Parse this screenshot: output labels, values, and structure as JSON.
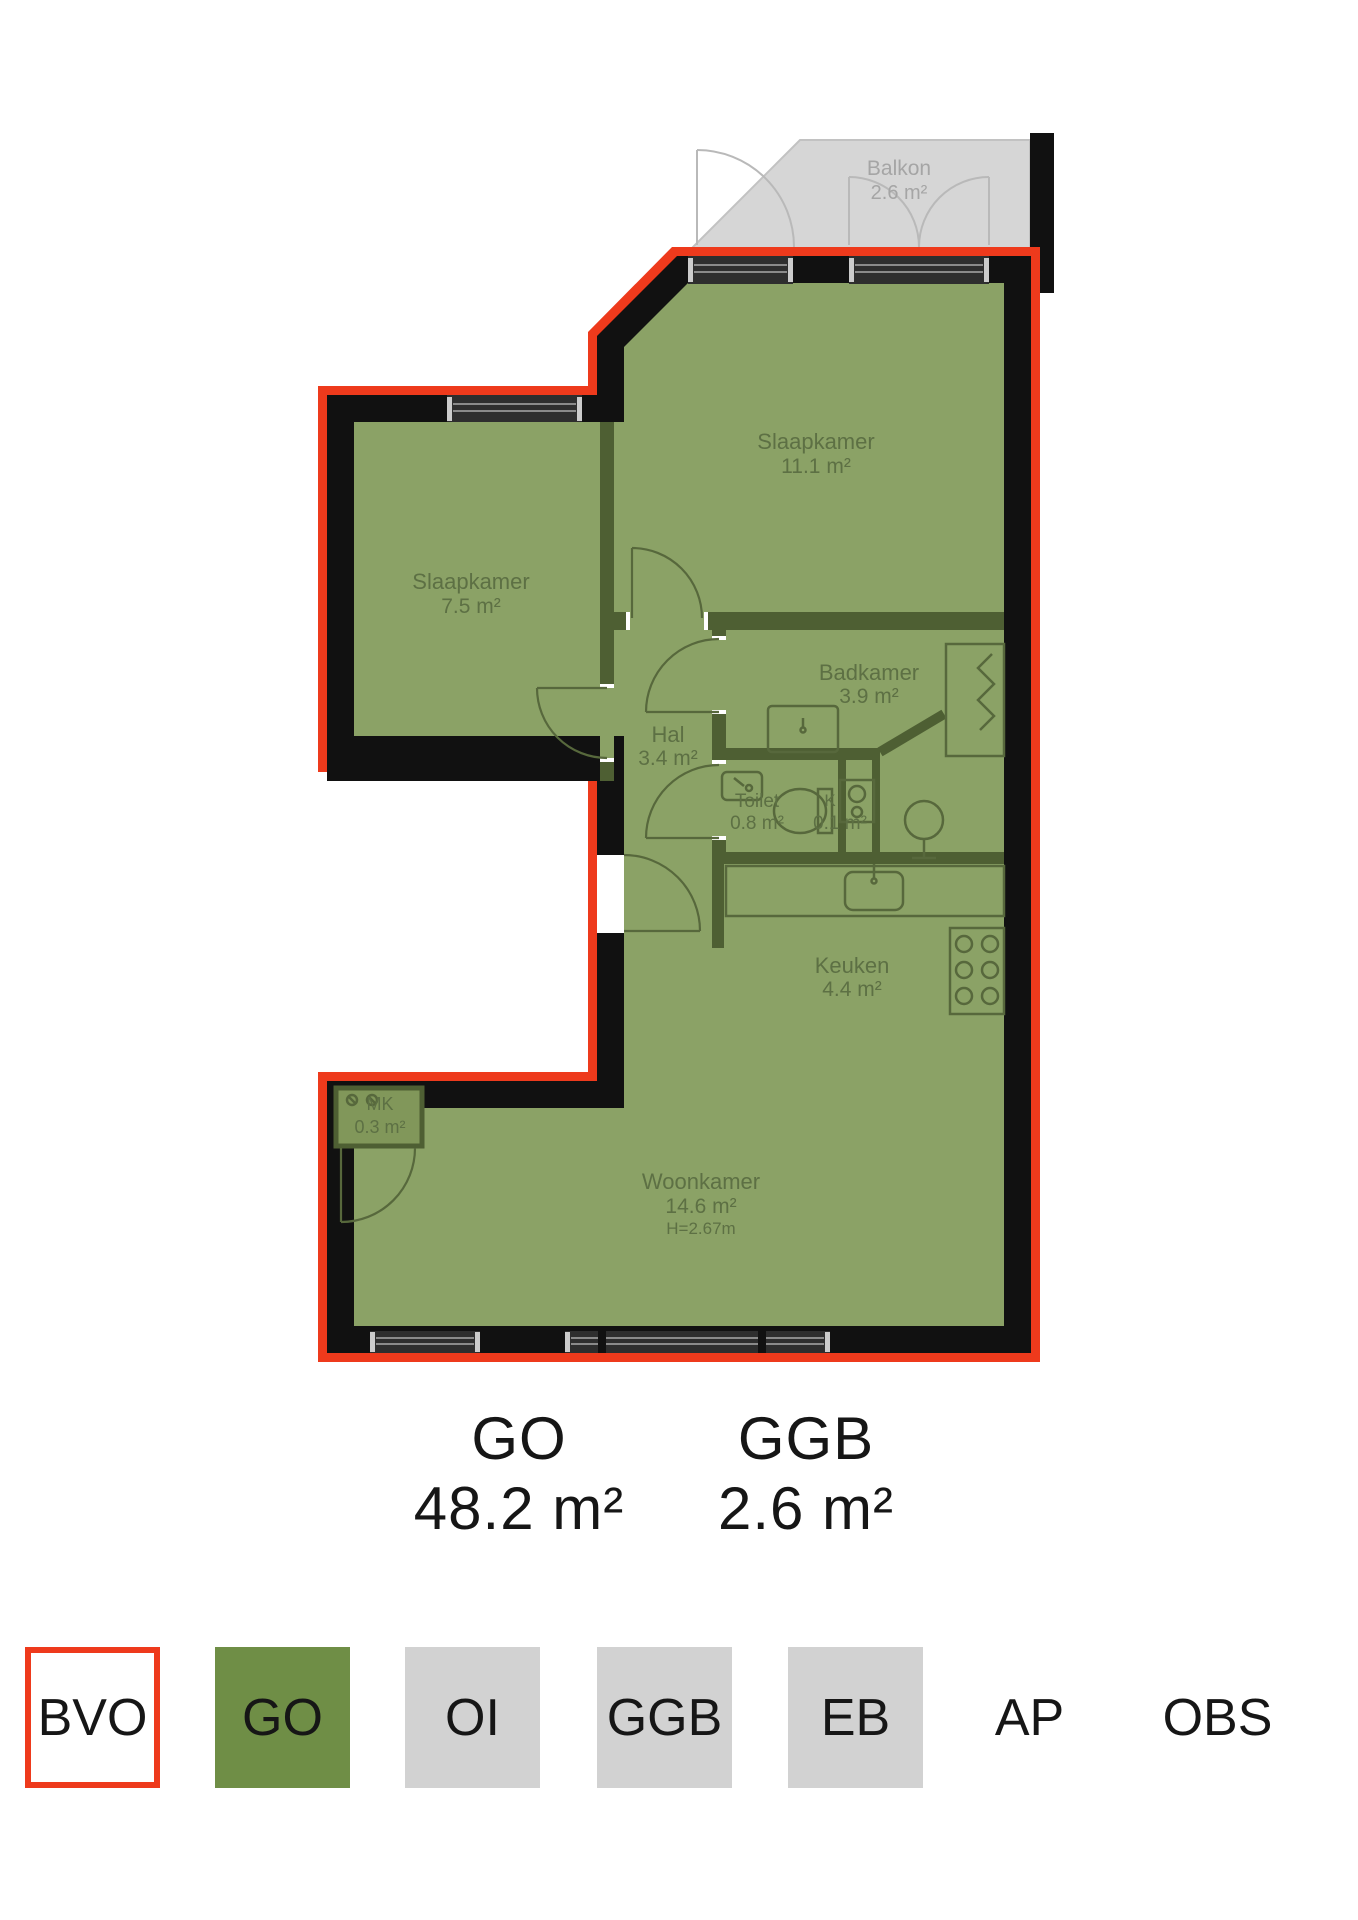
{
  "plan": {
    "balkon": {
      "name": "Balkon",
      "area": "2.6 m²"
    },
    "slaapkamer_groot": {
      "name": "Slaapkamer",
      "area": "11.1 m²"
    },
    "slaapkamer_klein": {
      "name": "Slaapkamer",
      "area": "7.5 m²"
    },
    "badkamer": {
      "name": "Badkamer",
      "area": "3.9 m²"
    },
    "hal": {
      "name": "Hal",
      "area": "3.4 m²"
    },
    "toilet": {
      "name": "Toilet",
      "area": "0.8 m²"
    },
    "koker": {
      "name": "K",
      "area": "0.1 m²"
    },
    "keuken": {
      "name": "Keuken",
      "area": "4.4 m²"
    },
    "meterkast": {
      "name": "MK",
      "area": "0.3 m²"
    },
    "woonkamer": {
      "name": "Woonkamer",
      "area": "14.6 m²",
      "ceiling_height": "H=2.67m"
    }
  },
  "totals": {
    "go_label": "GO",
    "go_value": "48.2 m²",
    "ggb_label": "GGB",
    "ggb_value": "2.6 m²"
  },
  "legend": {
    "items": [
      {
        "label": "BVO"
      },
      {
        "label": "GO"
      },
      {
        "label": "OI"
      },
      {
        "label": "GGB"
      },
      {
        "label": "EB"
      },
      {
        "label": "AP"
      },
      {
        "label": "OBS"
      }
    ]
  },
  "colors": {
    "bvo_outline": "#ee3a1c",
    "go_fill": "#8ba266",
    "interior_wall": "#4e5f33",
    "ggb_fill": "#d6d6d6",
    "legend_go": "#6f8e46",
    "legend_gray": "#d2d2d2",
    "wall_black": "#111111"
  }
}
